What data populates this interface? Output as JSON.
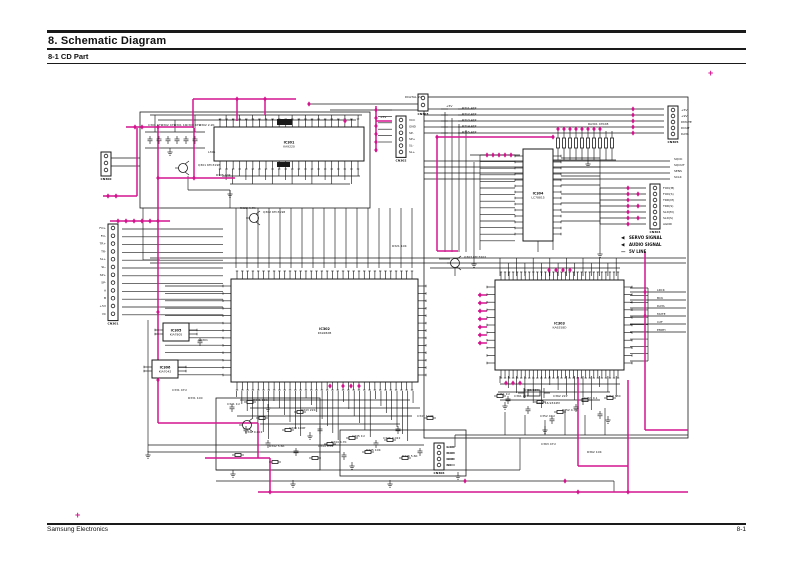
{
  "document": {
    "title": "8. Schematic Diagram",
    "subtitle": "8-1 CD Part",
    "footer_left": "Samsung Electronics",
    "footer_right": "8-1",
    "registration_glyph": "+"
  },
  "colors": {
    "accent": "#d4148f",
    "wire": "#1a1a1a"
  },
  "legend": {
    "items": [
      {
        "symbol": "◀",
        "label": "SERVO SIGNAL"
      },
      {
        "symbol": "◀",
        "label": "AUDIO SIGNAL"
      },
      {
        "symbol": "—",
        "label": "5V LINE"
      }
    ]
  },
  "schematic": {
    "ics": [
      {
        "ref": "IC301",
        "part": "KA9220",
        "x": 214,
        "y": 127,
        "w": 150,
        "h": 34,
        "pt": 22,
        "pb": 22,
        "pl": 0,
        "pr": 0
      },
      {
        "ref": "IC302",
        "part": "KS9282B",
        "x": 231,
        "y": 279,
        "w": 187,
        "h": 103,
        "pt": 34,
        "pb": 34,
        "pl": 13,
        "pr": 13
      },
      {
        "ref": "IC303",
        "part": "KA9258D",
        "x": 495,
        "y": 280,
        "w": 129,
        "h": 90,
        "pt": 30,
        "pb": 30,
        "pl": 11,
        "pr": 11
      },
      {
        "ref": "IC304",
        "part": "LC78815",
        "x": 523,
        "y": 149,
        "w": 30,
        "h": 92,
        "pt": 0,
        "pb": 0,
        "pl": 14,
        "pr": 14
      },
      {
        "ref": "IC305",
        "part": "KIA7805",
        "x": 163,
        "y": 323,
        "w": 26,
        "h": 18,
        "pt": 0,
        "pb": 0,
        "pl": 2,
        "pr": 2
      },
      {
        "ref": "IC306",
        "part": "KIA7042",
        "x": 152,
        "y": 360,
        "w": 26,
        "h": 18,
        "pt": 0,
        "pb": 0,
        "pl": 2,
        "pr": 2
      }
    ],
    "connectors": [
      {
        "ref": "CN301",
        "x": 108,
        "y": 224,
        "pins": 12,
        "sp": 7.8,
        "side": "left",
        "labels": [
          "FO+",
          "FO-",
          "TR+",
          "TR-",
          "SL+",
          "SL-",
          "SP+",
          "SP-",
          "A",
          "B",
          "+5V",
          "VC"
        ]
      },
      {
        "ref": "CN300",
        "x": 101,
        "y": 152,
        "pins": 3,
        "sp": 7,
        "side": "left",
        "labels": []
      },
      {
        "ref": "CN303",
        "x": 418,
        "y": 94,
        "pins": 2,
        "sp": 7,
        "side": "left",
        "labels": []
      },
      {
        "ref": "CN302",
        "x": 396,
        "y": 116,
        "pins": 6,
        "sp": 6.4,
        "side": "right",
        "labels": [
          "VCC",
          "GND",
          "SP-",
          "SP+",
          "SL-",
          "SL+"
        ]
      },
      {
        "ref": "CN305",
        "x": 668,
        "y": 106,
        "pins": 5,
        "sp": 6,
        "side": "right",
        "labels": [
          "+5V",
          "+9V",
          "DMUTE",
          "DOUT",
          "DATA"
        ]
      },
      {
        "ref": "CN304",
        "x": 650,
        "y": 184,
        "pins": 7,
        "sp": 6,
        "side": "right",
        "labels": [
          "FOD(M)",
          "FOD(S)",
          "TRD(M)",
          "TRD(S)",
          "SLD(M)",
          "SLD(S)",
          "AGND"
        ]
      },
      {
        "ref": "CN306",
        "x": 434,
        "y": 443,
        "pins": 4,
        "sp": 6,
        "side": "right",
        "labels": [
          "L-CH",
          "R-CH",
          "GND",
          "NC"
        ]
      }
    ],
    "micro_labels": [
      {
        "t": "C301 47U",
        "x": 148,
        "y": 126
      },
      {
        "t": "C302 47U",
        "x": 161,
        "y": 126
      },
      {
        "t": "R301 1K",
        "x": 174,
        "y": 126
      },
      {
        "t": "C303 47U",
        "x": 186,
        "y": 126
      },
      {
        "t": "R302 2.2K",
        "x": 199,
        "y": 126
      },
      {
        "t": "L301",
        "x": 208,
        "y": 153
      },
      {
        "t": "Q301 KTC3198",
        "x": 198,
        "y": 166
      },
      {
        "t": "R305 10K",
        "x": 216,
        "y": 176
      },
      {
        "t": "DIGITAL 9V",
        "x": 405,
        "y": 98
      },
      {
        "t": "+5V",
        "x": 446,
        "y": 107
      },
      {
        "t": "R311 47K",
        "x": 462,
        "y": 109
      },
      {
        "t": "R312 47K",
        "x": 462,
        "y": 115
      },
      {
        "t": "R313 47K",
        "x": 462,
        "y": 121
      },
      {
        "t": "R314 47K",
        "x": 462,
        "y": 127
      },
      {
        "t": "R315 47K",
        "x": 462,
        "y": 133
      },
      {
        "t": "RA301 47KX8",
        "x": 588,
        "y": 125
      },
      {
        "t": "R321 10K",
        "x": 392,
        "y": 247
      },
      {
        "t": "Q302 KTC3198",
        "x": 263,
        "y": 213
      },
      {
        "t": "R322 4.7K",
        "x": 240,
        "y": 209
      },
      {
        "t": "SQCK",
        "x": 674,
        "y": 160
      },
      {
        "t": "SQOUT",
        "x": 674,
        "y": 166
      },
      {
        "t": "SENS",
        "x": 674,
        "y": 172
      },
      {
        "t": "SCLK",
        "x": 674,
        "y": 178
      },
      {
        "t": "LRCK",
        "x": 657,
        "y": 291
      },
      {
        "t": "BCK",
        "x": 657,
        "y": 299
      },
      {
        "t": "DATA",
        "x": 657,
        "y": 307
      },
      {
        "t": "MUTE",
        "x": 657,
        "y": 315
      },
      {
        "t": "C2F",
        "x": 657,
        "y": 323
      },
      {
        "t": "EMPH",
        "x": 657,
        "y": 331
      },
      {
        "t": "Q303 KTC3202",
        "x": 464,
        "y": 258
      },
      {
        "t": "X301 16.9344M",
        "x": 536,
        "y": 404
      },
      {
        "t": "C361 22P",
        "x": 514,
        "y": 397
      },
      {
        "t": "C362 22P",
        "x": 553,
        "y": 397
      },
      {
        "t": "C341 1U",
        "x": 227,
        "y": 405
      },
      {
        "t": "R341 10K",
        "x": 253,
        "y": 401
      },
      {
        "t": "C342 0.022",
        "x": 245,
        "y": 433
      },
      {
        "t": "R342 5.6K",
        "x": 269,
        "y": 447
      },
      {
        "t": "C343 100P",
        "x": 289,
        "y": 429
      },
      {
        "t": "R343 22K",
        "x": 301,
        "y": 411
      },
      {
        "t": "C344 0.01",
        "x": 318,
        "y": 447
      },
      {
        "t": "R344 4.7K",
        "x": 331,
        "y": 443
      },
      {
        "t": "C345 1U",
        "x": 352,
        "y": 437
      },
      {
        "t": "R345 10K",
        "x": 366,
        "y": 451
      },
      {
        "t": "C346 0.022",
        "x": 383,
        "y": 439
      },
      {
        "t": "R346 5.6K",
        "x": 402,
        "y": 457
      },
      {
        "t": "C347 100P",
        "x": 417,
        "y": 417
      },
      {
        "t": "C351 1U",
        "x": 497,
        "y": 395
      },
      {
        "t": "R351 10K",
        "x": 524,
        "y": 391
      },
      {
        "t": "C352 47U",
        "x": 540,
        "y": 417
      },
      {
        "t": "R352 4.7K",
        "x": 562,
        "y": 411
      },
      {
        "t": "C353 0.1",
        "x": 584,
        "y": 399
      },
      {
        "t": "R353 330",
        "x": 606,
        "y": 397
      },
      {
        "t": "VR301",
        "x": 198,
        "y": 341
      },
      {
        "t": "C331 47U",
        "x": 172,
        "y": 391
      },
      {
        "t": "R331 100",
        "x": 188,
        "y": 399
      },
      {
        "t": "C363 47U",
        "x": 541,
        "y": 445
      },
      {
        "t": "R362 10K",
        "x": 587,
        "y": 453
      },
      {
        "t": "+5V",
        "x": 380,
        "y": 118
      }
    ]
  }
}
